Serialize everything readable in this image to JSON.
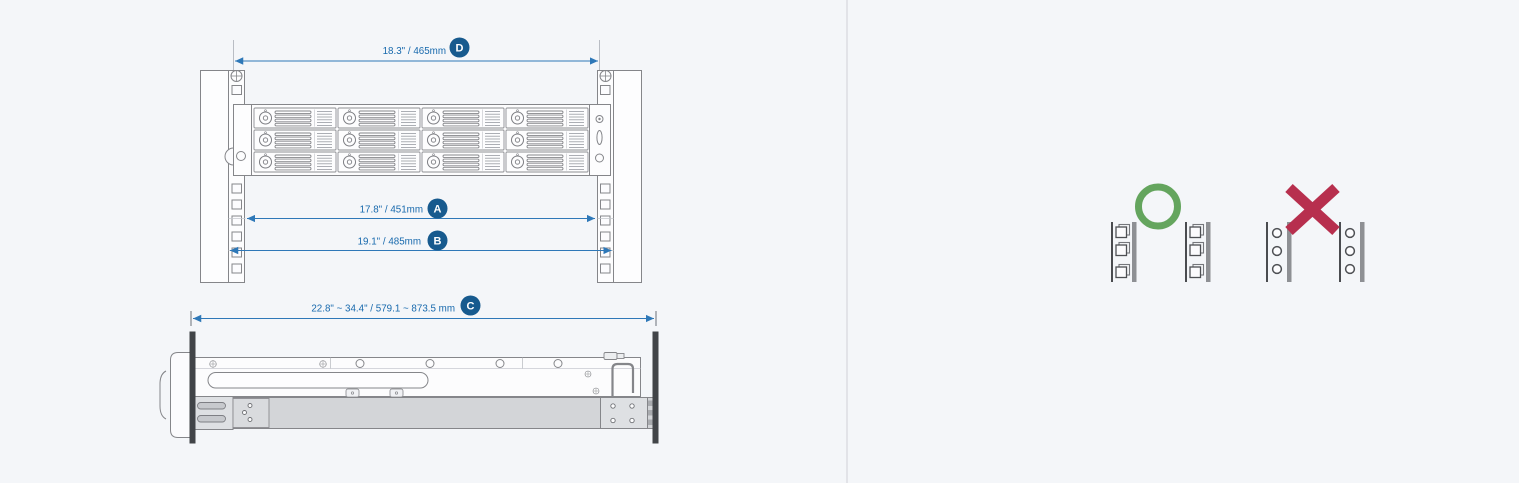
{
  "colors": {
    "background": "#f4f6f9",
    "divider": "#e2e3e8",
    "dimension_line_blue": "#2e78b8",
    "dimension_text_blue": "#1769ad",
    "badge_blue": "#175a8e",
    "badge_text": "#ffffff",
    "drawing_outline_gray": "#85868a",
    "rail_gray": "#d3d5d8",
    "rack_post_dark": "#414448",
    "correct_green": "#64a55e",
    "incorrect_red": "#b72f4e"
  },
  "front_view": {
    "description_icon": "rack-front-view-drawing",
    "dim_d": {
      "label": "18.3\" / 465mm",
      "badge": "D"
    },
    "dim_a": {
      "label": "17.8\" / 451mm",
      "badge": "A"
    },
    "dim_b": {
      "label": "19.1\" / 485mm",
      "badge": "B"
    },
    "drive_bays": {
      "rows": 3,
      "columns": 4
    }
  },
  "side_view": {
    "description_icon": "rail-side-view-drawing",
    "dim_c": {
      "label": "22.8\" ~ 34.4\" / 579.1 ~ 873.5 mm",
      "badge": "C"
    }
  },
  "hole_guide": {
    "correct": {
      "mark_icon": "circle-ok-icon",
      "rail_hole_type": "square"
    },
    "incorrect": {
      "mark_icon": "x-mark-icon",
      "rail_hole_type": "round"
    }
  }
}
